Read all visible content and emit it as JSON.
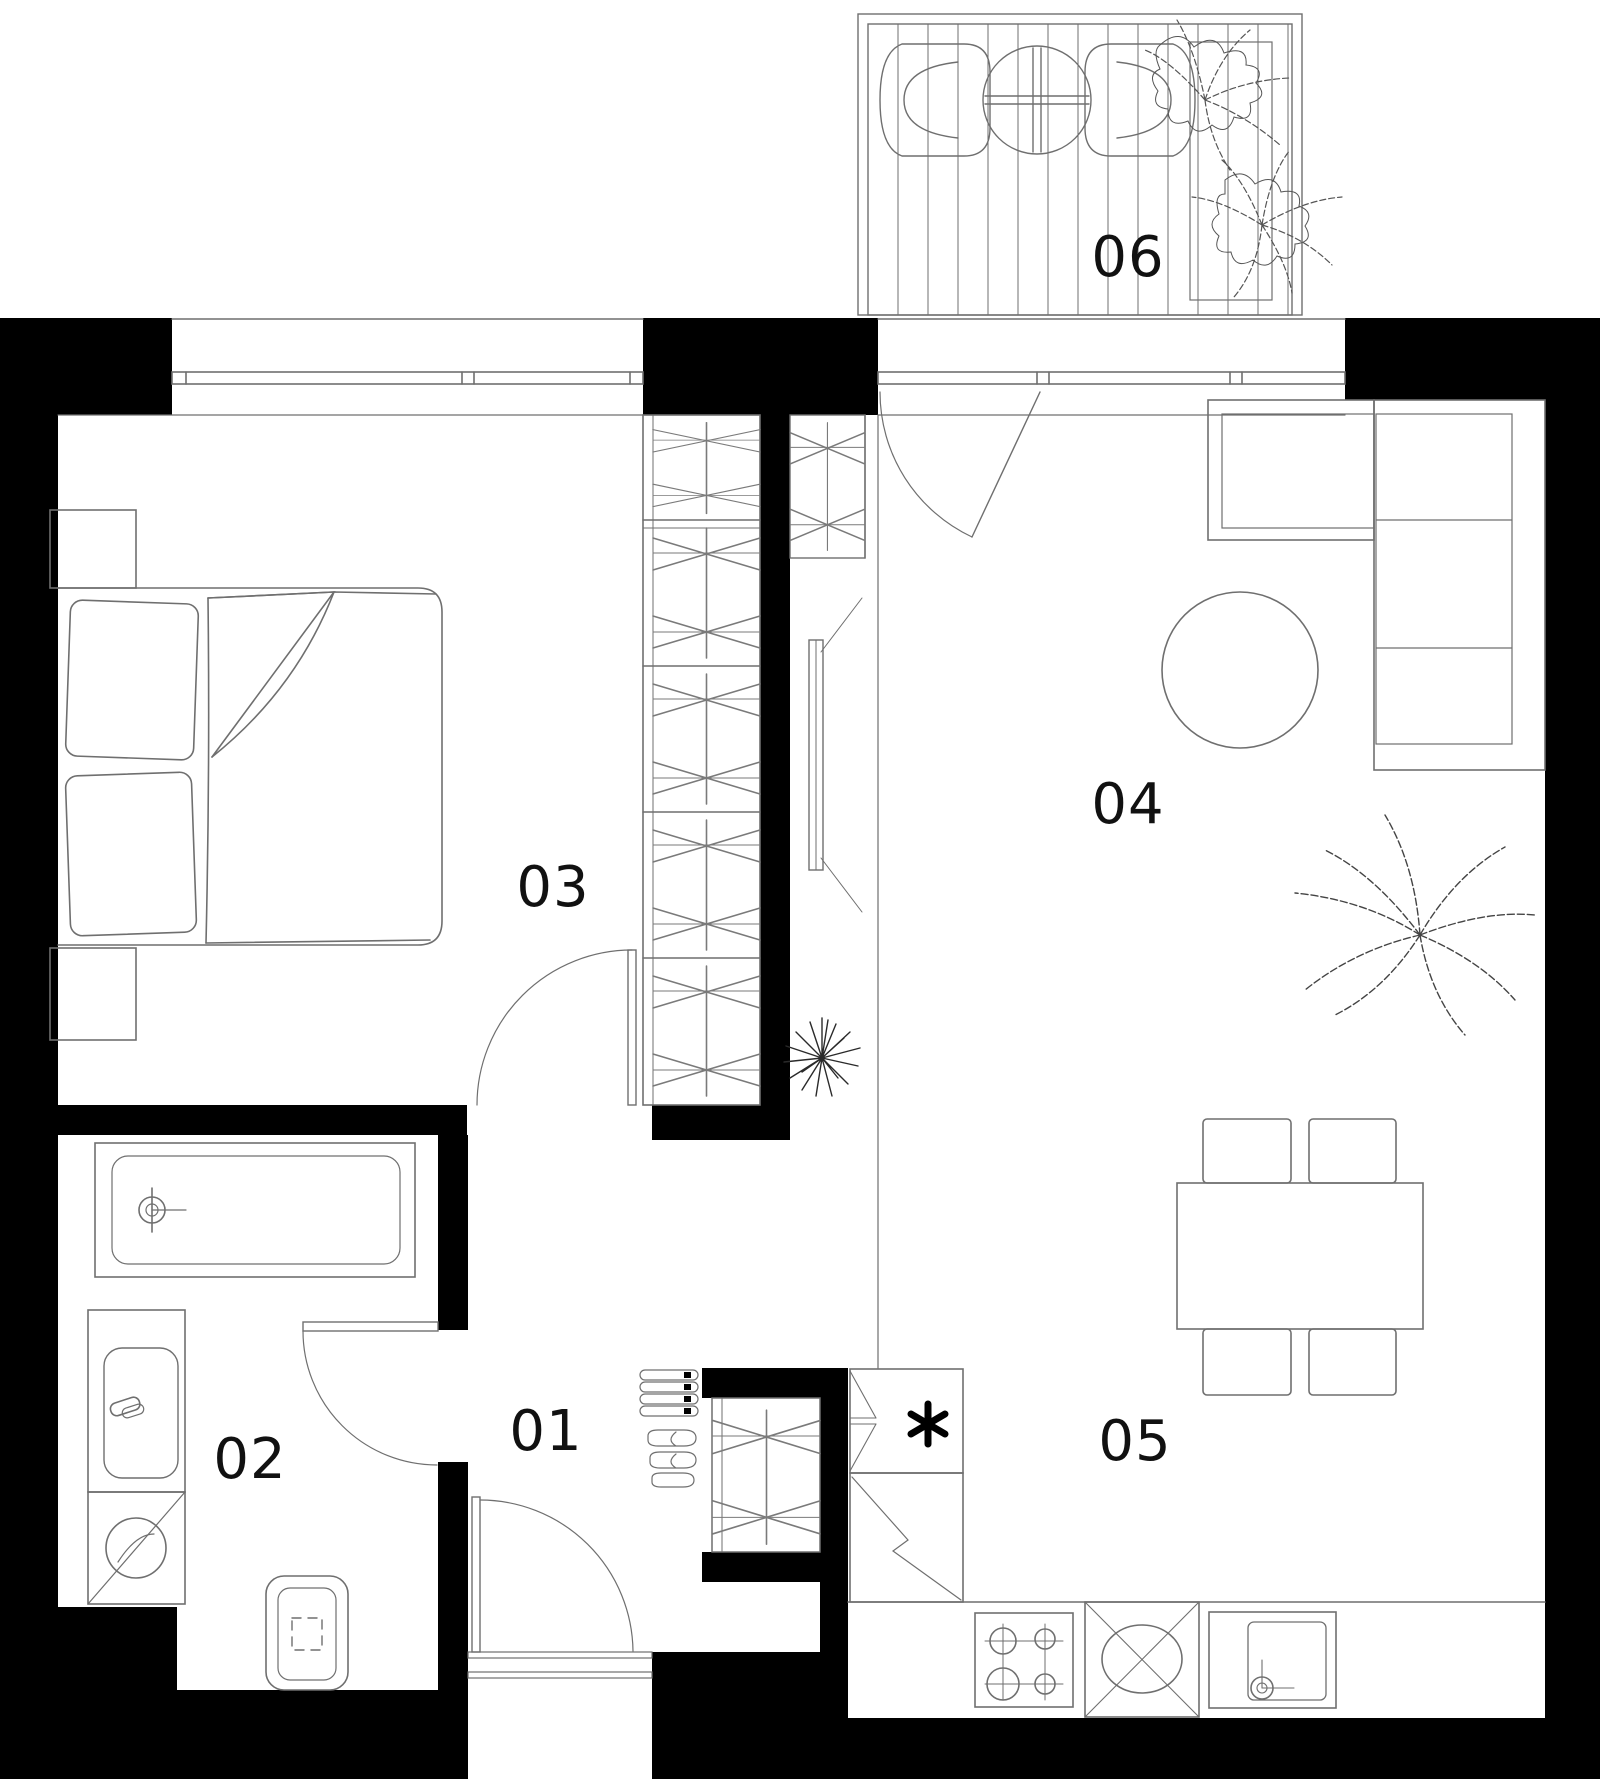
{
  "page": {
    "background": "#ffffff"
  },
  "colors": {
    "wall_fill": "#000000",
    "line": "#6f6f6f",
    "label": "#111111"
  },
  "rooms": {
    "r01": {
      "label": "01"
    },
    "r02": {
      "label": "02"
    },
    "r03": {
      "label": "03"
    },
    "r04": {
      "label": "04"
    },
    "r05": {
      "label": "05"
    },
    "r06": {
      "label": "06"
    }
  },
  "icons": {
    "freezer": "asterisk-6-spoke-icon",
    "bed": "double-bed-icon",
    "wardrobe": "wardrobe-hatch-icon",
    "bathtub": "bathtub-icon",
    "washing_machine": "washing-machine-icon",
    "toilet": "toilet-icon",
    "sink": "sink-icon",
    "stove": "stove-4-burner-icon",
    "sofa": "corner-sofa-icon",
    "coffee_table": "round-table-icon",
    "dining_table": "dining-table-icon",
    "plant": "plant-icon",
    "door_swing": "door-swing-arc-icon",
    "window": "window-sill-icon",
    "shoes": "shoes-icon",
    "tv": "tv-panel-icon"
  }
}
